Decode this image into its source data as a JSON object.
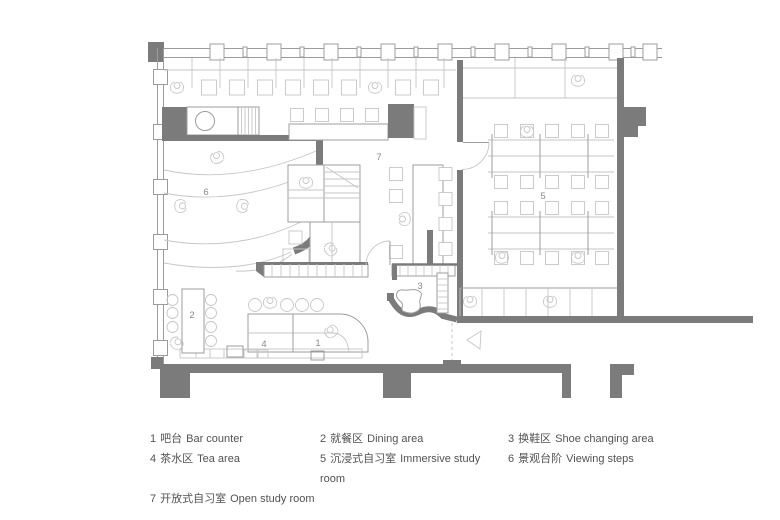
{
  "title": "Study cafe floor plan",
  "colors": {
    "wall": "#7b7b7b",
    "line_mid": "#9c9c9c",
    "line_light": "#c6c6c6",
    "label": "#8a8a8a",
    "text": "#525252"
  },
  "legend": {
    "items": [
      {
        "number": "1",
        "zh": "吧台",
        "en": "Bar counter"
      },
      {
        "number": "2",
        "zh": "就餐区",
        "en": "Dining area"
      },
      {
        "number": "3",
        "zh": "换鞋区",
        "en": "Shoe changing area"
      },
      {
        "number": "4",
        "zh": "茶水区",
        "en": "Tea area"
      },
      {
        "number": "5",
        "zh": "沉浸式自习室",
        "en": "Immersive study room"
      },
      {
        "number": "6",
        "zh": "景观台阶",
        "en": "Viewing steps"
      },
      {
        "number": "7",
        "zh": "开放式自习室",
        "en": "Open study room"
      }
    ]
  }
}
